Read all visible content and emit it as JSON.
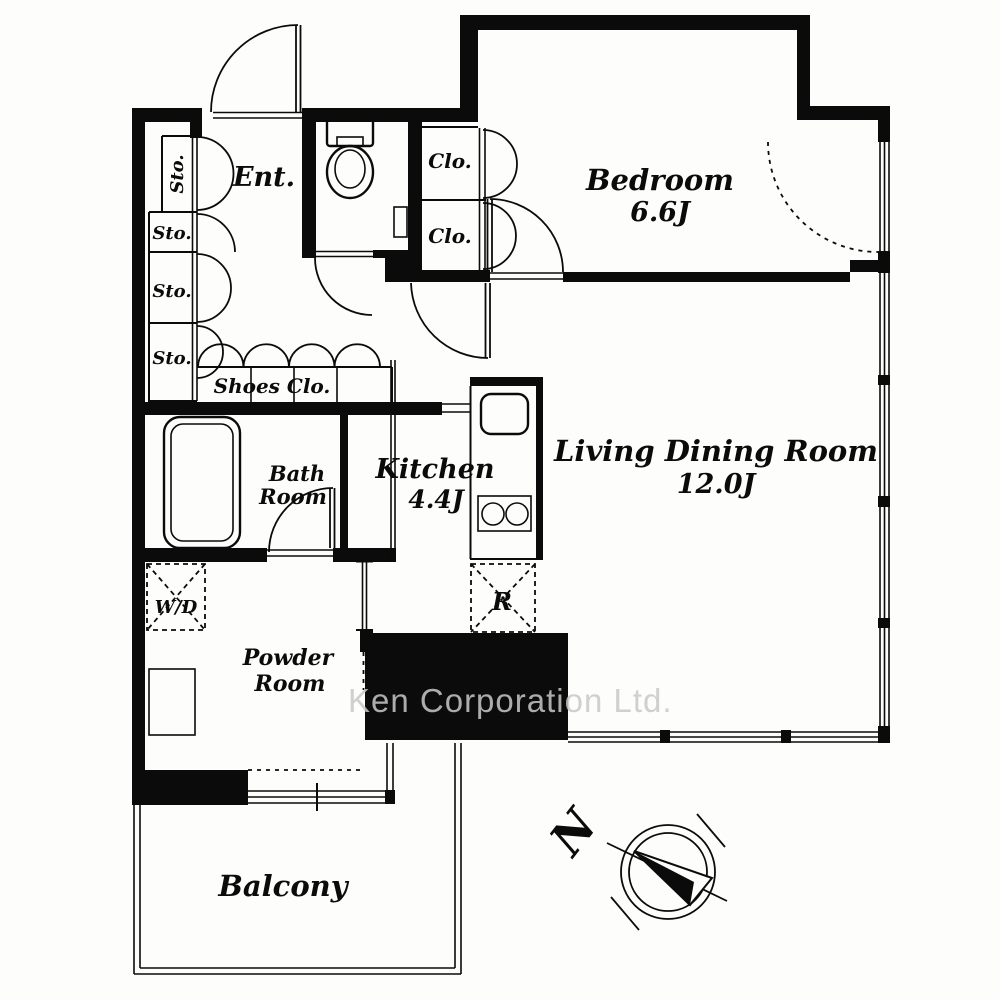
{
  "rooms": {
    "bedroom": {
      "label": "Bedroom",
      "size": "6.6J"
    },
    "living_dining": {
      "label": "Living Dining Room",
      "size": "12.0J"
    },
    "kitchen": {
      "label": "Kitchen",
      "size": "4.4J"
    },
    "bathroom": {
      "label_line1": "Bath",
      "label_line2": "Room"
    },
    "powder_room": {
      "label_line1": "Powder",
      "label_line2": "Room"
    },
    "entrance": {
      "label": "Ent."
    },
    "balcony": {
      "label": "Balcony"
    }
  },
  "fixtures": {
    "storage": [
      "Sto.",
      "Sto.",
      "Sto.",
      "Sto."
    ],
    "closets": [
      "Clo.",
      "Clo."
    ],
    "shoes_closet": "Shoes Clo.",
    "washer_dryer": "W/D",
    "refrigerator": "R"
  },
  "compass": {
    "north": "N"
  },
  "watermark": {
    "text": "Ken Corporation Ltd.",
    "color": "#c9c9c9"
  },
  "colors": {
    "walls": "#0b0b0b",
    "background": "#fdfdfb"
  }
}
